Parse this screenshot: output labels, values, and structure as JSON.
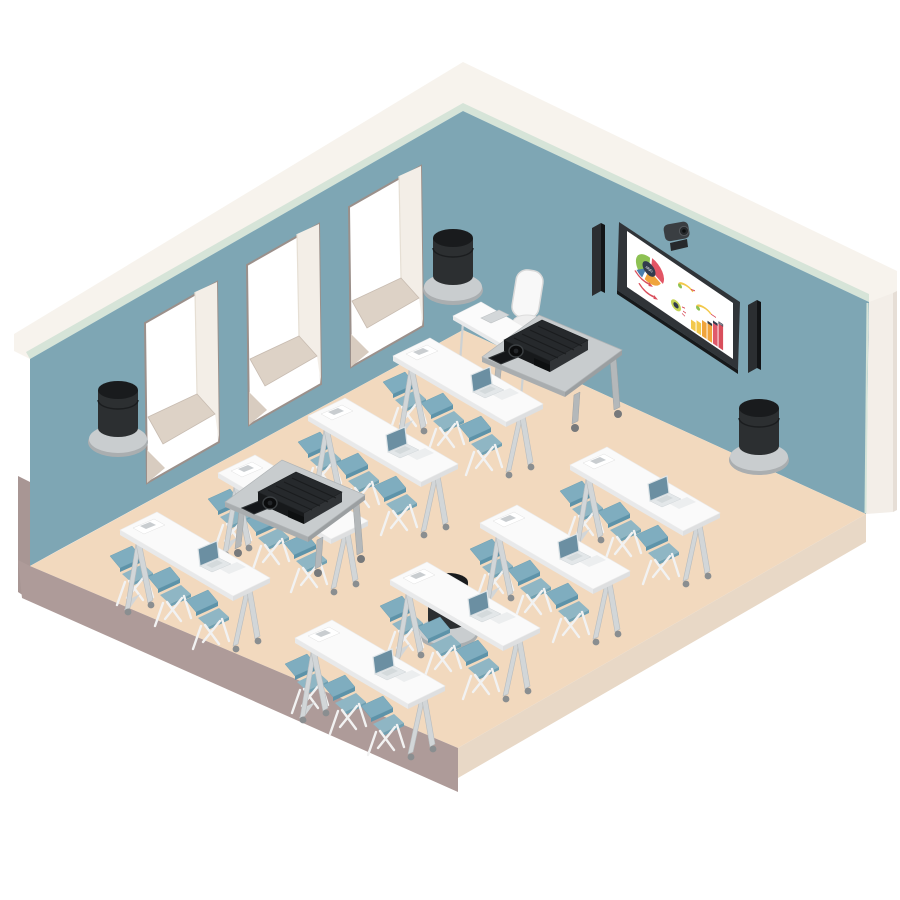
{
  "scene": {
    "description": "Isometric flat-vector illustration of a classroom / training room equipped for video conferencing",
    "donut_center_label": "450",
    "bar_top_label": "5M"
  },
  "palette": {
    "wall": "#7ea6b4",
    "wall_trim": "#f7f3ed",
    "wall_trim_mint": "#d6e4d8",
    "wall_edge": "#f3eee8",
    "floor": "#f2d9be",
    "floor_edge_left": "#ae9b99",
    "floor_edge_right": "#e8d8c6",
    "window_frame": "#9b908b",
    "window_sill": "#ddd2c6",
    "table_top": "#fafafa",
    "table_leg": "#d2d6d8",
    "chair_back": "#7fadbf",
    "chair_seat": "#8fb6c4",
    "chair_frame": "#f2f2f2",
    "laptop_lid": "#6b8fa2",
    "cart_top": "#c8ccce",
    "device_black": "#1f2224",
    "display_frame": "#303438",
    "screen_white": "#ffffff"
  },
  "inventory": {
    "windows": 3,
    "student_tables": 8,
    "folding_chairs": 24,
    "laptops": 7,
    "presenter_desk": 1,
    "presenter_chair": 1,
    "av_carts": 2,
    "projectors": 2,
    "control_tablets": 2,
    "cylinder_speakers": 4,
    "soundbars": 2,
    "wall_displays": 1,
    "ptz_cameras": 1
  },
  "chart_data": [
    {
      "type": "pie",
      "location": "wall-display",
      "center_label": "450",
      "segments": [
        {
          "name": "green",
          "value": 37,
          "color": "#8dc153"
        },
        {
          "name": "red",
          "value": 31,
          "color": "#e25565"
        },
        {
          "name": "orange",
          "value": 24,
          "color": "#f0a43c"
        },
        {
          "name": "blue",
          "value": 8,
          "color": "#4a7fae"
        }
      ]
    },
    {
      "type": "bar",
      "location": "wall-display",
      "values": [
        9,
        12,
        16,
        19,
        23,
        26
      ],
      "colors": [
        "#f2c84b",
        "#f2c84b",
        "#f0a43c",
        "#f0a43c",
        "#e05a6b",
        "#d94f5c"
      ],
      "top_label": "5M",
      "annotations": [
        "red trend arrows",
        "gauge icons",
        "target icon"
      ]
    }
  ]
}
